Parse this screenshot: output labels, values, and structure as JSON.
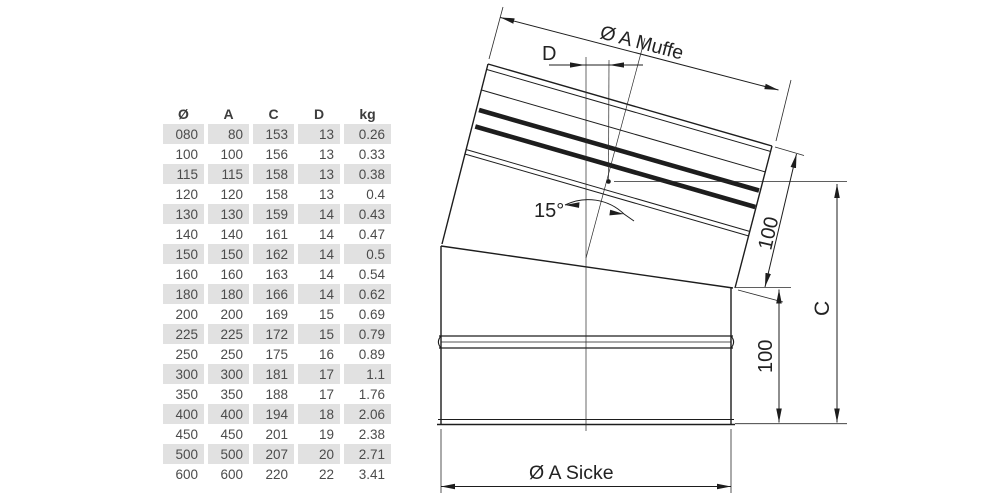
{
  "table": {
    "headers": [
      "Ø",
      "A",
      "C",
      "D",
      "kg"
    ],
    "rows": [
      [
        "080",
        "80",
        "153",
        "13",
        "0.26"
      ],
      [
        "100",
        "100",
        "156",
        "13",
        "0.33"
      ],
      [
        "115",
        "115",
        "158",
        "13",
        "0.38"
      ],
      [
        "120",
        "120",
        "158",
        "13",
        "0.4"
      ],
      [
        "130",
        "130",
        "159",
        "14",
        "0.43"
      ],
      [
        "140",
        "140",
        "161",
        "14",
        "0.47"
      ],
      [
        "150",
        "150",
        "162",
        "14",
        "0.5"
      ],
      [
        "160",
        "160",
        "163",
        "14",
        "0.54"
      ],
      [
        "180",
        "180",
        "166",
        "14",
        "0.62"
      ],
      [
        "200",
        "200",
        "169",
        "15",
        "0.69"
      ],
      [
        "225",
        "225",
        "172",
        "15",
        "0.79"
      ],
      [
        "250",
        "250",
        "175",
        "16",
        "0.89"
      ],
      [
        "300",
        "300",
        "181",
        "17",
        "1.1"
      ],
      [
        "350",
        "350",
        "188",
        "17",
        "1.76"
      ],
      [
        "400",
        "400",
        "194",
        "18",
        "2.06"
      ],
      [
        "450",
        "450",
        "201",
        "19",
        "2.38"
      ],
      [
        "500",
        "500",
        "207",
        "20",
        "2.71"
      ],
      [
        "600",
        "600",
        "220",
        "22",
        "3.41"
      ]
    ]
  },
  "diagram": {
    "labels": {
      "muffe": "Ø A Muffe",
      "offset_d": "D",
      "angle": "15°",
      "len_upper": "100",
      "len_lower": "100",
      "height_c": "C",
      "sicke": "Ø A Sicke"
    }
  },
  "colors": {
    "line": "#1d1d1d",
    "row_stripe": "#e1e1e1",
    "table_text": "#4b4b4b"
  }
}
